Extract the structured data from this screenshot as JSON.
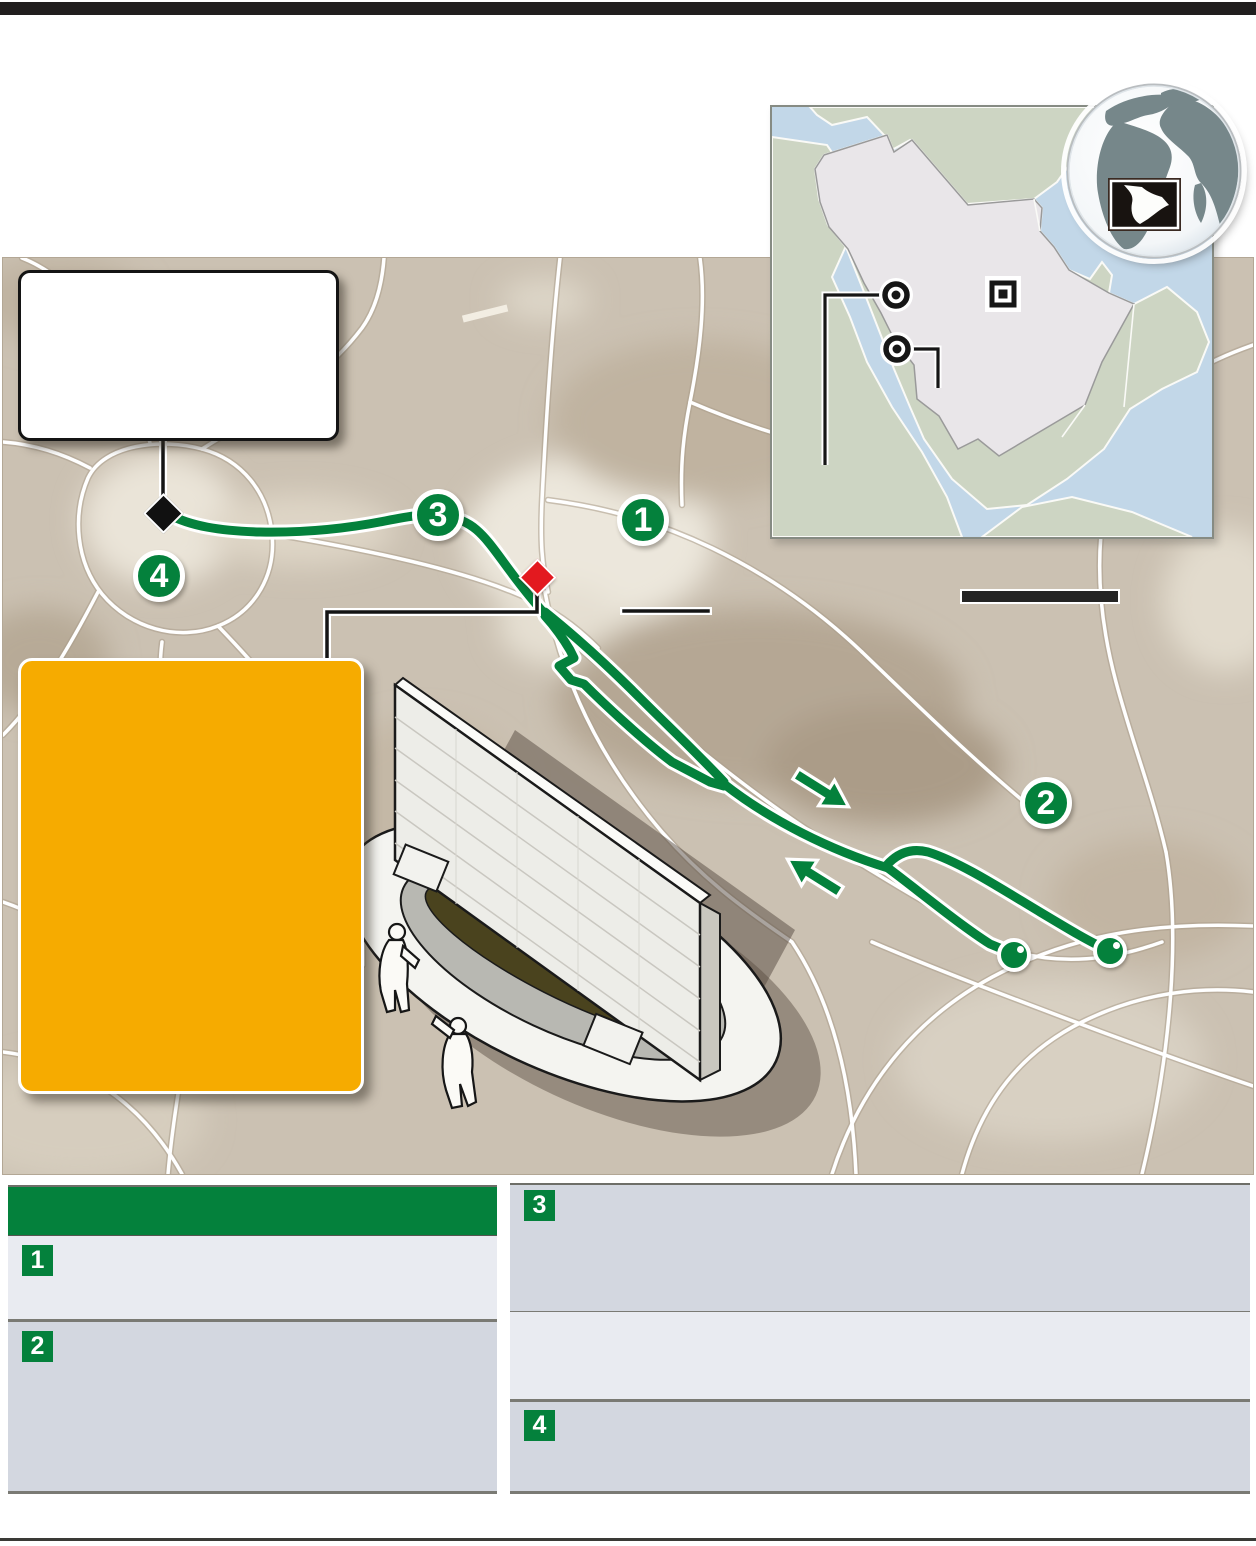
{
  "map_markers": [
    {
      "label": "1"
    },
    {
      "label": "2"
    },
    {
      "label": "3"
    },
    {
      "label": "4"
    }
  ],
  "legend": {
    "badges": [
      "1",
      "2",
      "3",
      "4"
    ]
  },
  "colors": {
    "route_green": "#04813C",
    "accent_orange": "#F6AB00",
    "marker_red": "#E3191F",
    "map_tan": "#CBC1B2",
    "table_header_green": "#04813C",
    "table_row_light": "#E9EBF1",
    "table_row_dark": "#D3D7E0",
    "sea_blue": "#C2D7E8",
    "land_green": "#CDD5C3",
    "country_fill_gray": "#E9E6E9",
    "globe_land": "#76878A",
    "top_bar": "#211E1E"
  }
}
